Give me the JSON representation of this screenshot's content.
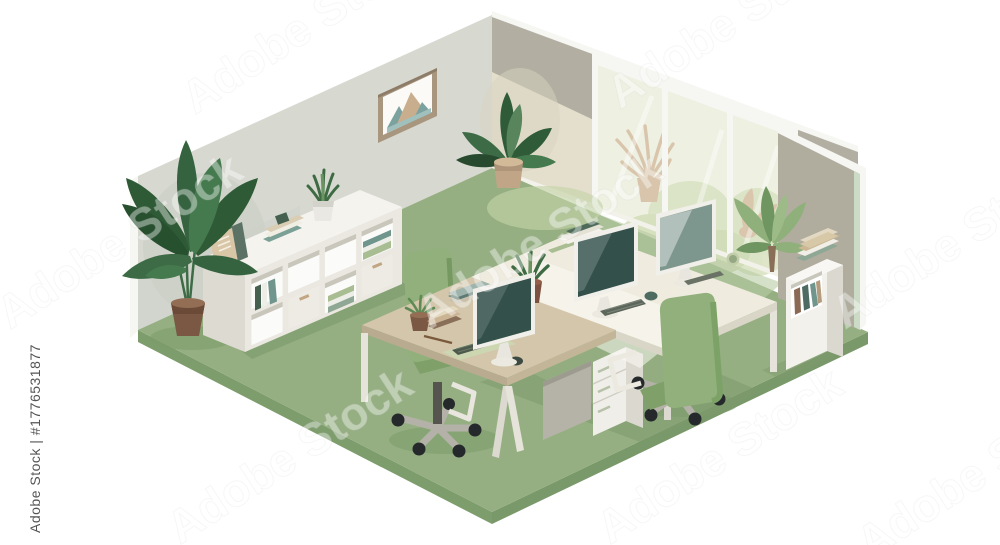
{
  "image": {
    "type": "stock-illustration-preview",
    "subject": "Isometric vector illustration of an office room with workstation desks, computer monitors, green office chairs, bookshelves and potted plants on a green floor"
  },
  "watermark": {
    "diagonal_text": "Adobe Stock",
    "vertical_text": "Adobe Stock | #1776531877"
  },
  "palette": {
    "background": "#ffffff",
    "wall_left": "#d7d9d1",
    "wall_corner": "#b2afa2",
    "wall_right": "#b0ad9f",
    "wall_trim": "#f6f6f2",
    "wall_inner_edge_mint": "#ccdbc5",
    "glass": "#eef0e2",
    "outdoor_foliage": "#dce4c6",
    "outdoor_plant_tan": "#d9c4ab",
    "floor": "#95af82",
    "floor_edge": "#7e9d6d",
    "floor_sunlight": "#bcccA2",
    "shadow_green": "#7c9a6b",
    "desk_tan": "#d3c6ab",
    "desk_tan_edge": "#b8ab8f",
    "desk_white": "#efecdf",
    "desk_white_edge": "#d9d6c8",
    "screen_teal": "#33504b",
    "screen_light": "#7e978e",
    "chair_green": "#92b07b",
    "chair_base_gray": "#b4b2a8",
    "caster_black": "#26292b",
    "furniture_white": "#f2f1ec",
    "book_teal": "#6f958c",
    "book_dark_green": "#46604f",
    "book_sage": "#a9bd92",
    "book_beige": "#d9c6a6",
    "book_brown": "#8a6f58",
    "plant_dark": "#2f5a36",
    "plant_mid": "#3c6b45",
    "plant_light": "#8fb07a",
    "pot_brown": "#7b5843",
    "pot_tan": "#c0a687",
    "frame_taupe": "#a9967f",
    "art_teal": "#7ba29e",
    "art_tan": "#c9ae8e",
    "watermark_gray": "#3d3d3d"
  },
  "scene": {
    "elements": [
      "left-wall",
      "corner-wall",
      "panoramic-window",
      "right-wall",
      "green-floor",
      "mountain-picture-frame",
      "white-sideboard-with-cubbies",
      "binders",
      "book-stacks",
      "tall-banana-plant",
      "corner-broadleaf-plant",
      "snake-plants",
      "succulent",
      "palm-plant",
      "outdoor-spider-plant",
      "outdoor-bushes",
      "tan-desk",
      "white-desk",
      "three-monitors",
      "keyboards",
      "mice",
      "desk-pad",
      "laptop",
      "pencil",
      "mug",
      "drawer-pedestal",
      "green-office-chair-left",
      "green-office-chair-front",
      "small-white-bookcase"
    ]
  }
}
